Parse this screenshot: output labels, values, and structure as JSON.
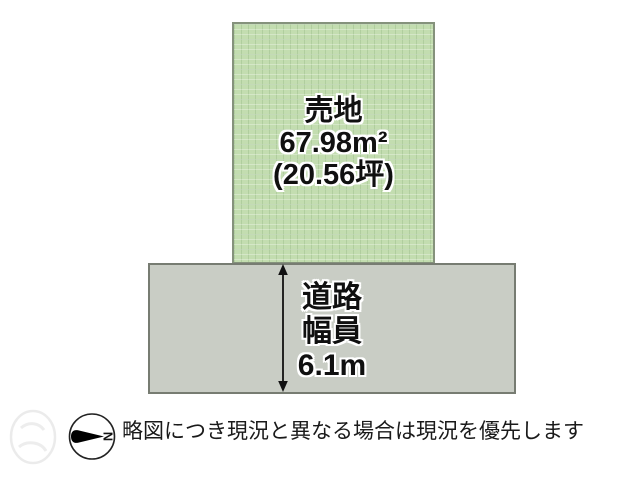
{
  "diagram": {
    "lot": {
      "title": "売地",
      "area_m2": "67.98m²",
      "area_tsubo": "(20.56坪)",
      "fill_color": "#c3ddb0",
      "border_color": "#85927c"
    },
    "road": {
      "label_line1": "道路",
      "label_line2": "幅員",
      "width_value": "6.1m",
      "fill_color": "#c9cdc5",
      "border_color": "#777c72"
    },
    "compass": {
      "north_label": "N"
    },
    "note": {
      "text": "略図につき現況と異なる場合は現況を優先します"
    }
  }
}
